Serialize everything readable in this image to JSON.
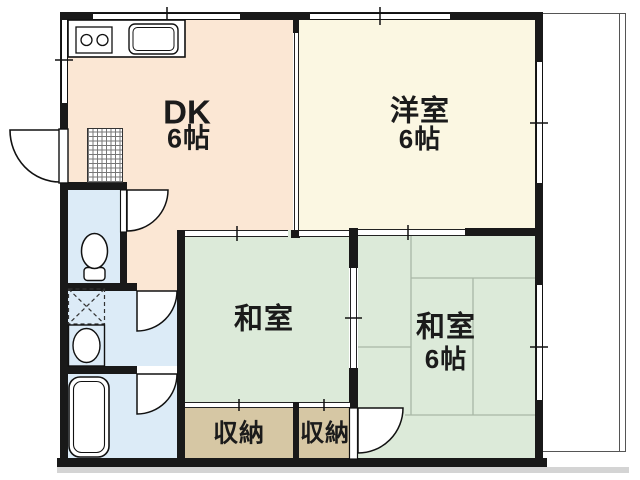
{
  "document": {
    "type": "japanese-apartment-floor-plan"
  },
  "colors": {
    "wall": "#191919",
    "dk": "#fbe7d4",
    "western": "#fbf7e2",
    "tatami": "#dcead9",
    "storage": "#d6c7a4",
    "wet": "#dcebf7",
    "tatami_line": "#a9b7a6",
    "shadow": "#c6c6c6"
  },
  "rooms": {
    "dk": {
      "label": "DK",
      "size": "6帖"
    },
    "western": {
      "label": "洋室",
      "size": "6帖"
    },
    "tatami_center": {
      "label": "和室"
    },
    "tatami_right": {
      "label": "和室",
      "size": "6帖"
    },
    "storage_left": {
      "label": "収納"
    },
    "storage_right": {
      "label": "収納"
    }
  },
  "fixtures": {
    "kitchen_counter": "kitchen counter with 2-burner stove and sink",
    "toilet": "toilet",
    "washing_machine_pan": "washing machine pan",
    "wash_basin": "wash basin",
    "bathtub": "bathtub",
    "genkan": "entrance tile",
    "balcony": "balcony"
  }
}
